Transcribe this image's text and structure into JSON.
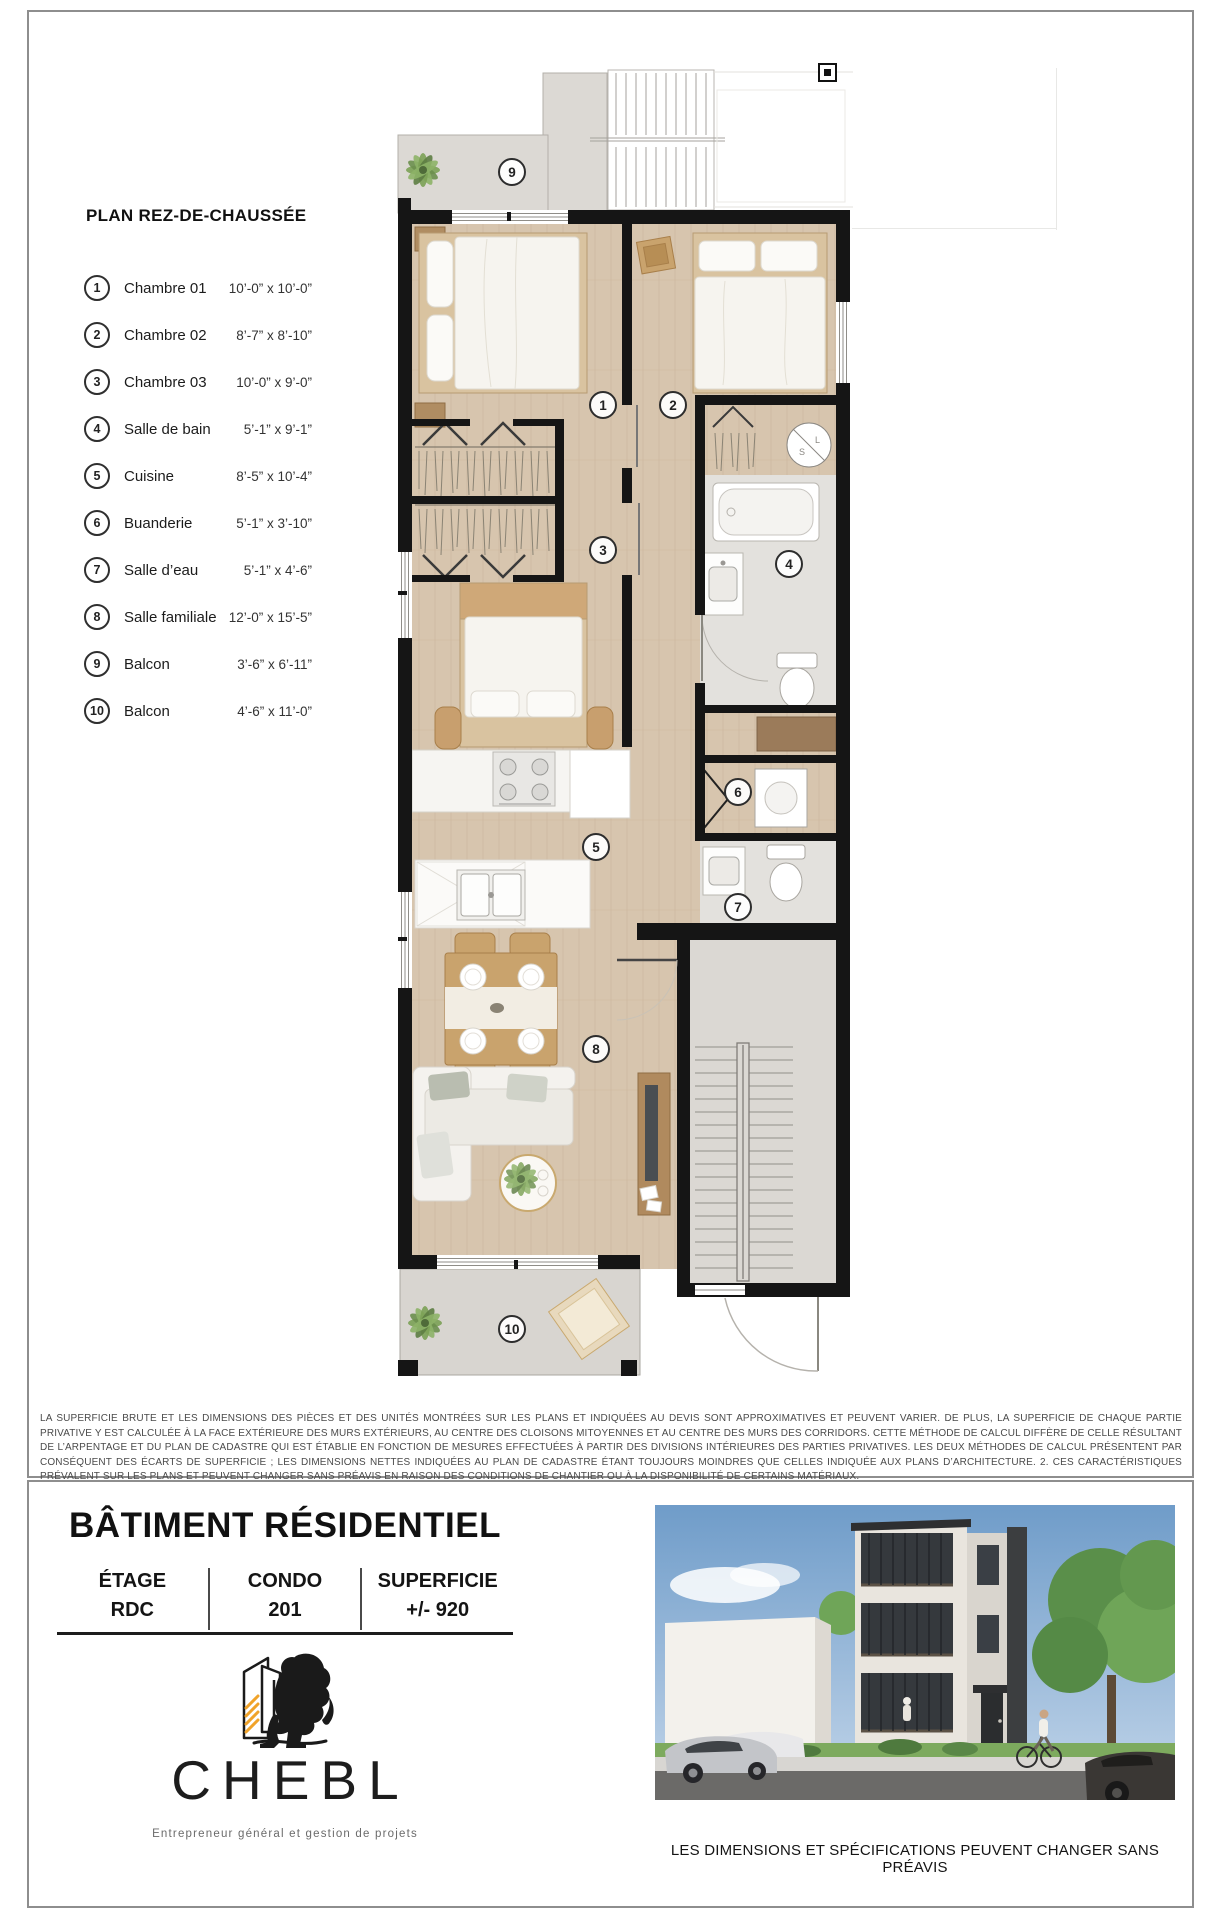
{
  "page": {
    "legend_title": "PLAN REZ-DE-CHAUSSÉE"
  },
  "legend": {
    "items": [
      {
        "num": "1",
        "name": "Chambre 01",
        "dims": "10’-0” x 10’-0”"
      },
      {
        "num": "2",
        "name": "Chambre 02",
        "dims": "8’-7” x 8’-10”"
      },
      {
        "num": "3",
        "name": "Chambre 03",
        "dims": "10’-0” x 9’-0”"
      },
      {
        "num": "4",
        "name": "Salle de bain",
        "dims": "5’-1” x 9’-1”"
      },
      {
        "num": "5",
        "name": "Cuisine",
        "dims": "8’-5” x 10’-4”"
      },
      {
        "num": "6",
        "name": "Buanderie",
        "dims": "5’-1” x 3’-10”"
      },
      {
        "num": "7",
        "name": "Salle d’eau",
        "dims": "5’-1” x 4’-6”"
      },
      {
        "num": "8",
        "name": "Salle familiale",
        "dims": "12’-0” x 15’-5”"
      },
      {
        "num": "9",
        "name": "Balcon",
        "dims": "3’-6” x 6’-11”"
      },
      {
        "num": "10",
        "name": "Balcon",
        "dims": "4’-6” x 11’-0”"
      }
    ]
  },
  "plan": {
    "markers": [
      {
        "num": "1",
        "x": 603,
        "y": 405
      },
      {
        "num": "2",
        "x": 673,
        "y": 405
      },
      {
        "num": "3",
        "x": 603,
        "y": 550
      },
      {
        "num": "4",
        "x": 789,
        "y": 564
      },
      {
        "num": "5",
        "x": 596,
        "y": 847
      },
      {
        "num": "6",
        "x": 738,
        "y": 792
      },
      {
        "num": "7",
        "x": 738,
        "y": 907
      },
      {
        "num": "8",
        "x": 596,
        "y": 1049
      },
      {
        "num": "9",
        "x": 512,
        "y": 172
      },
      {
        "num": "10",
        "x": 512,
        "y": 1329
      }
    ]
  },
  "disclaimer": "LA SUPERFICIE BRUTE ET LES DIMENSIONS DES PIÈCES ET DES UNITÉS MONTRÉES SUR LES PLANS ET INDIQUÉES AU DEVIS SONT APPROXIMATIVES ET PEUVENT VARIER. DE PLUS, LA SUPERFICIE DE CHAQUE PARTIE PRIVATIVE Y EST CALCULÉE À LA FACE EXTÉRIEURE DES MURS EXTÉRIEURS, AU CENTRE DES CLOISONS MITOYENNES ET AU CENTRE DES MURS DES CORRIDORS. CETTE MÉTHODE DE CALCUL DIFFÈRE DE CELLE RÉSULTANT DE L’ARPENTAGE ET DU PLAN DE CADASTRE QUI EST ÉTABLIE EN FONCTION DE MESURES EFFECTUÉES À PARTIR DES DIVISIONS INTÉRIEURES DES PARTIES PRIVATIVES. LES DEUX MÉTHODES DE CALCUL PRÉSENTENT PAR CONSÉQUENT DES ÉCARTS DE SUPERFICIE ; LES DIMENSIONS NETTES INDIQUÉES AU PLAN DE CADASTRE ÉTANT TOUJOURS MOINDRES QUE CELLES INDIQUÉE AUX PLANS D’ARCHITECTURE. 2. CES CARACTÉRISTIQUES PRÉVALENT SUR LES PLANS ET PEUVENT CHANGER SANS PRÉAVIS EN RAISON DES CONDITIONS DE CHANTIER OU À LA DISPONIBILITÉ DE CERTAINS MATÉRIAUX.",
  "footer": {
    "building_title": "BÂTIMENT RÉSIDENTIEL",
    "columns": [
      {
        "label": "ÉTAGE",
        "value": "RDC"
      },
      {
        "label": "CONDO",
        "value": "201"
      },
      {
        "label": "SUPERFICIE",
        "value": "+/- 920"
      }
    ],
    "logo": {
      "name": "CHEBL",
      "tagline": "Entrepreneur général et gestion de projets"
    },
    "caption": "LES DIMENSIONS ET SPÉCIFICATIONS PEUVENT CHANGER SANS PRÉAVIS"
  },
  "colors": {
    "wall": "#151515",
    "floor_wood": "#d7c5ae",
    "wet_room": "#e3e1dd",
    "balcony": "#d8d5d0",
    "logo_accent": "#f0a32a"
  }
}
